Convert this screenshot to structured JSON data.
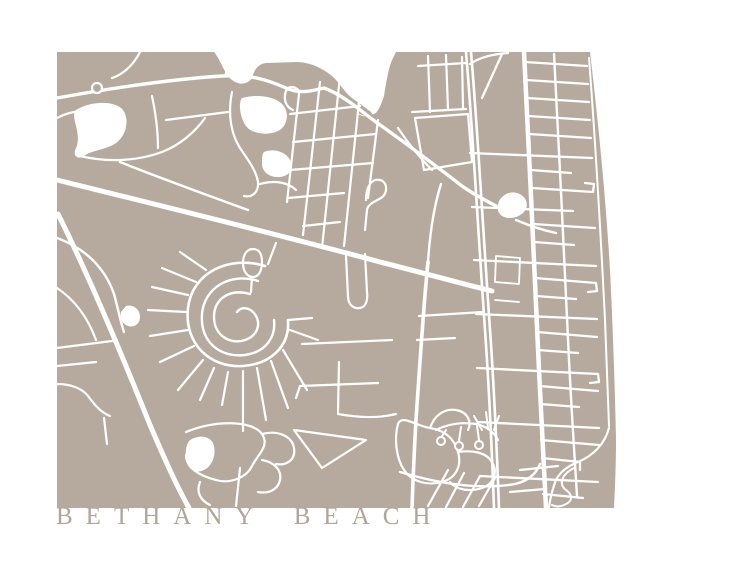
{
  "title": {
    "text": "BETHANY BEACH"
  },
  "map": {
    "colors": {
      "land": "#b6aa9e",
      "water": "#ffffff",
      "road": "#ffffff",
      "title": "#b1a597"
    },
    "landmass": "M57,52 L214,52 C222,62 224,74 232,80 C240,86 248,84 252,78 C254,70 258,64 266,63 L298,62 C312,63 322,68 332,76 C340,83 344,92 352,98 C360,104 366,108 371,112 L373,115 C368,117 362,116 356,112 L358,114 C364,118 370,116 376,113 C380,108 382,102 384,96 C386,84 388,70 392,60 L396,52 L590,52 C598,120 606,200 610,270 C613,330 615,390 616,440 C616,465 615,488 614,508 L57,508 Z",
    "waters": [
      "M76,110 C90,101 115,100 123,110 C130,120 126,136 116,143 C106,150 92,150 84,156 C78,160 72,156 76,148 C79,142 78,134 76,126 C74,118 73,113 76,110 Z",
      "M242,98 C256,94 274,96 282,104 C290,112 288,126 278,131 C268,136 252,134 246,126 C240,118 238,103 242,98 Z",
      "M264,152 C274,148 286,152 290,160 C294,168 290,176 280,177 C270,178 262,172 262,164 C262,158 262,154 264,152 Z",
      "M126,306 C134,304 140,310 140,317 C140,324 134,328 128,326 C122,324 120,318 121,312 Z",
      "M190,440 C200,434 212,436 214,446 C216,456 212,466 204,470 C196,474 188,470 186,460 C185,452 186,444 190,440 Z",
      "M499,209 C498,199 507,192 516,194 C526,196 529,207 521,213 C513,219 500,218 499,209 Z"
    ],
    "roads": [
      [
        "M57,98 C90,92 160,80 222,76 C250,74 268,80 286,88 C302,95 314,90 324,88 C345,96 362,112 376,122 C404,142 436,166 462,186 C476,196 487,201 496,206",
        3.4
      ],
      [
        "M516,220 C530,226 542,230 556,233",
        2.4
      ],
      [
        "M57,180 C150,203 300,240 380,262 C420,272 455,282 492,291",
        5
      ],
      [
        "M58,214 C85,268 120,350 150,425 C163,455 175,483 189,508",
        5
      ],
      [
        "M466,52 C472,120 478,230 485,330 C490,400 492,455 494,508",
        2.6
      ],
      [
        "M471,52 C477,120 483,230 490,330 C495,400 497,455 499,508",
        2.6
      ],
      [
        "M428,262 C424,300 420,360 416,420 C414,455 413,480 412,508",
        3.6
      ],
      [
        "M428,262 C430,232 434,206 441,184",
        2.4
      ],
      [
        "M524,52 C529,150 535,280 539,370 C542,430 544,470 546,508",
        4.5
      ],
      [
        "M554,54 C559,150 565,270 569,360 C572,420 575,462 577,496",
        2.4
      ],
      [
        "M589,58 C596,150 601,240 605,320 C607,370 608,400 609,426",
        2
      ],
      [
        "M525,62 L587,66",
        2.3
      ],
      [
        "M526,80 L588,84",
        2.3
      ],
      [
        "M527,98 L589,102",
        2.3
      ],
      [
        "M528,116 L590,120",
        2.3
      ],
      [
        "M529,134 L591,138",
        2.3
      ],
      [
        "M470,153 L592,158",
        2.3
      ],
      [
        "M531,170 L571,173",
        2.3
      ],
      [
        "M532,188 L593,192 L594,184 L585,183",
        2.3
      ],
      [
        "M472,207 L573,211",
        2.3
      ],
      [
        "M533,224 L595,228",
        2.3
      ],
      [
        "M534,242 L574,245",
        2.3
      ],
      [
        "M474,260 L596,266",
        2.3
      ],
      [
        "M535,278 L596,283 L597,291 L588,292",
        2.3
      ],
      [
        "M536,296 L576,299",
        2.3
      ],
      [
        "M476,314 L597,319",
        2.3
      ],
      [
        "M537,332 L597,337",
        2.3
      ],
      [
        "M538,350 L578,353",
        2.3
      ],
      [
        "M477,368 L598,374 L599,382 L590,383",
        2.3
      ],
      [
        "M539,386 L598,391",
        2.3
      ],
      [
        "M540,404 L579,407",
        2.3
      ],
      [
        "M478,422 L599,428",
        2.3
      ],
      [
        "M541,440 L599,445",
        2.3
      ],
      [
        "M542,458 L580,462 L580,470",
        2.3
      ],
      [
        "M480,476 L598,482",
        2.3
      ],
      [
        "M543,494 L583,498",
        2.3
      ],
      [
        "M470,64 C480,57 494,54 508,53",
        2.3
      ],
      [
        "M482,98 L502,54",
        2.3
      ],
      [
        "M496,256 L520,258 L519,284 L495,282 Z",
        1.8
      ],
      [
        "M495,300 L519,302",
        1.8
      ],
      [
        "M300,92 C294,84 286,86 285,95 C284,103 288,108 293,110",
        2.2
      ],
      [
        "M299,94 L287,202",
        2.2
      ],
      [
        "M320,82 L303,235",
        2.2
      ],
      [
        "M340,76 L322,248",
        2.2
      ],
      [
        "M360,92 L344,246",
        2.2
      ],
      [
        "M378,120 L368,198",
        2.2
      ],
      [
        "M290,114 L360,106",
        2.2
      ],
      [
        "M293,142 L376,134",
        2.2
      ],
      [
        "M290,170 L373,163",
        2.2
      ],
      [
        "M288,198 L344,193",
        2.2
      ],
      [
        "M303,226 L340,222",
        2.2
      ],
      [
        "M366,200 C366,186 372,178 380,180 C388,182 388,194 381,198 C374,202 368,204 367,210 L365,230",
        2.2
      ],
      [
        "M346,256 L348,296 C348,306 355,309 360,308 C366,307 368,300 367,292 L365,254",
        2.2
      ],
      [
        "M428,56 L430,112",
        2.2
      ],
      [
        "M446,55 L448,110",
        2.2
      ],
      [
        "M462,57 L463,108",
        2.2
      ],
      [
        "M412,112 L466,109",
        2.2
      ],
      [
        "M418,66 L466,63",
        2.2
      ],
      [
        "M415,118 L468,114 L472,162 L424,170 Z",
        2.2
      ],
      [
        "M398,128 C410,146 420,158 432,170",
        2.2
      ],
      [
        "M499,209 C498,199 507,192 516,194 C526,196 529,207 521,213 C513,219 500,218 499,209 Z",
        2.4
      ],
      [
        "M265,266 C230,255 192,272 188,308 C184,344 210,368 243,366 C271,364 290,346 288,320",
        2.6
      ],
      [
        "M258,281 C230,272 204,288 202,314 C200,342 220,358 245,355 C266,352 276,337 274,320",
        2.4
      ],
      [
        "M250,294 C228,288 214,300 214,317 C214,336 231,345 245,340 C257,336 261,325 256,316 C251,307 241,306 237,312",
        2.4
      ],
      [
        "M253,249 C246,249 243,256 243,263 C243,271 247,277 253,277 C259,277 262,270 262,262 C262,254 259,249 253,249 Z",
        2.2
      ],
      [
        "M252,277 L251,292",
        2.2
      ],
      [
        "M188,295 L152,287",
        2.2
      ],
      [
        "M186,312 L148,310",
        2.2
      ],
      [
        "M188,330 L150,336",
        2.2
      ],
      [
        "M194,346 L160,362",
        2.2
      ],
      [
        "M203,360 L178,390",
        2.2
      ],
      [
        "M214,368 L200,400",
        2.2
      ],
      [
        "M228,372 L222,405",
        2.2
      ],
      [
        "M243,371 L243,431",
        2.2
      ],
      [
        "M257,368 L266,420",
        2.2
      ],
      [
        "M271,361 L288,408",
        2.2
      ],
      [
        "M283,350 L307,390",
        2.2
      ],
      [
        "M290,330 L318,340",
        2.2
      ],
      [
        "M196,282 L162,268",
        2.2
      ],
      [
        "M206,270 L180,252",
        2.2
      ],
      [
        "M288,320 L312,318",
        2.2
      ],
      [
        "M268,264 L276,243",
        2.2
      ],
      [
        "M302,344 L392,340",
        2.2
      ],
      [
        "M296,398 L300,386 L378,383",
        2.2
      ],
      [
        "M338,414 C360,418 380,418 396,414",
        2.2
      ],
      [
        "M339,362 L338,412",
        2.2
      ],
      [
        "M294,430 L366,440 L322,468 Z",
        2.2
      ],
      [
        "M419,316 L483,312",
        2.2
      ],
      [
        "M417,340 L455,338",
        2.2
      ],
      [
        "M186,432 C215,420 252,420 262,434 C270,446 258,454 252,466 C246,478 230,484 216,480 C200,476 186,468 186,455",
        2.2
      ],
      [
        "M262,434 C278,430 292,436 294,448 C296,460 286,466 276,464",
        2.2
      ],
      [
        "M200,482 C196,492 200,500 210,505",
        2.2
      ],
      [
        "M240,468 L236,506",
        2.2
      ],
      [
        "M262,460 C274,462 282,470 280,480 C278,490 268,494 258,492",
        2.2
      ],
      [
        "M398,424 C394,438 396,458 404,470 C412,482 428,486 442,482 C456,478 462,466 458,452 C454,438 444,430 430,428 C416,426 402,414 398,424",
        2.2
      ],
      [
        "M458,452 C472,450 486,452 492,462 C498,472 494,484 482,488 C470,492 456,490 450,482",
        2.2
      ],
      [
        "M430,428 C434,416 444,408 456,410 C468,412 472,422 468,430",
        2.2
      ],
      [
        "M436,430 C448,424 462,422 476,424 C486,426 494,432 498,440",
        2.2
      ],
      [
        "M482,430 L474,416",
        2
      ],
      [
        "M488,428 L486,412",
        2
      ],
      [
        "M494,430 L499,416",
        2
      ],
      [
        "M446,430 L442,436",
        2
      ],
      [
        "M461,427 L459,441",
        2
      ],
      [
        "M477,426 L479,440",
        2
      ],
      [
        "M428,506 L448,470",
        2.2
      ],
      [
        "M446,507 L464,473",
        2.2
      ],
      [
        "M463,507 L480,476",
        2.2
      ],
      [
        "M479,506 L495,478",
        2.2
      ],
      [
        "M400,472 C440,484 480,490 515,484 C528,481 536,474 540,464",
        2.4
      ],
      [
        "M574,468 C562,474 558,484 566,490 C574,496 572,502 564,505 C560,507 556,507 552,505",
        2
      ],
      [
        "M609,428 C604,446 592,456 578,462 C568,466 560,472 556,480 C552,490 550,500 549,507",
        2.2
      ],
      [
        "M520,470 L558,466",
        2.2
      ],
      [
        "M510,492 L545,489",
        2.2
      ],
      [
        "M120,162 C165,180 210,196 248,210",
        2.4
      ],
      [
        "M57,238 C85,248 105,268 114,294 C118,308 120,320 124,332",
        2.4
      ],
      [
        "M57,288 C75,300 88,318 96,340",
        2.2
      ],
      [
        "M57,348 L112,341",
        2.2
      ],
      [
        "M57,366 L96,362",
        2.2
      ],
      [
        "M57,384 C70,384 82,388 88,396 C94,404 100,412 110,416",
        2.2
      ],
      [
        "M104,418 L107,444",
        2.2
      ],
      [
        "M140,52 C134,64 124,74 112,78",
        2.2
      ],
      [
        "M80,156 C105,162 135,162 162,152 C180,145 195,132 205,118",
        2.2
      ],
      [
        "M152,96 C156,115 158,130 158,148",
        2.2
      ],
      [
        "M232,92 C228,112 230,132 240,148 C248,160 256,170 258,182 C259,192 252,198 244,196",
        2.2
      ],
      [
        "M260,184 C274,180 288,182 296,190",
        2.2
      ],
      [
        "M166,120 L228,112",
        2.2
      ],
      [
        "M225,76 L232,56",
        2.2
      ],
      [
        "M57,118 C68,112 80,110 92,112",
        2.2
      ]
    ],
    "rings": [
      [
        97,
        88,
        5,
        2.2
      ],
      [
        441,
        441,
        4,
        2
      ],
      [
        459,
        446,
        4,
        2
      ],
      [
        479,
        445,
        4,
        2
      ]
    ]
  }
}
